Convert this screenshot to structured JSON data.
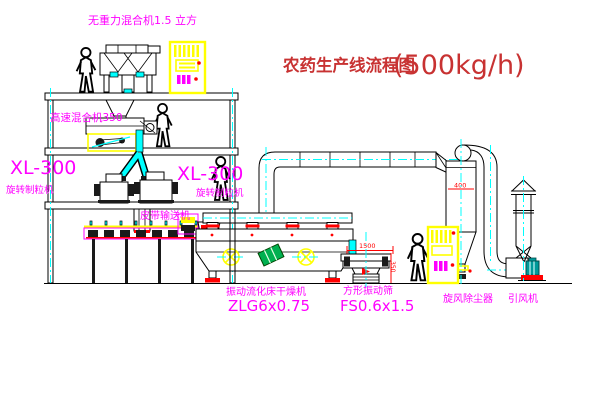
{
  "title": {
    "name": "农药生产线流程图",
    "capacity": "(500kg/h)"
  },
  "equipment": {
    "gravity_free_mixer": "无重力混合机1.5 立方",
    "high_speed_mixer": "高速混合机350",
    "granulator_left_model": "XL-300",
    "granulator_left_name": "旋转制粒机",
    "granulator_right_model": "XL-300",
    "granulator_right_name": "旋转制粒机",
    "belt_conveyor": "皮带输送机",
    "dryer_name": "振动流化床干燥机",
    "dryer_model": "ZLG6x0.75",
    "sieve_name": "方形振动筛",
    "sieve_model": "FS0.6x1.5",
    "cyclone": "旋风除尘器",
    "induced_draft_fan": "引风机"
  },
  "dimensions": {
    "sieve_length": "1500",
    "sieve_height": "350",
    "cyclone_mark": "400"
  },
  "colors": {
    "label_magenta": "#ff00ff",
    "title_red": "#c83232",
    "centerline_cyan": "#00ffff",
    "cabinet_yellow": "#ffff00",
    "alert_red": "#ff0000",
    "motor_green": "#00b050",
    "fan_teal": "#009999"
  }
}
